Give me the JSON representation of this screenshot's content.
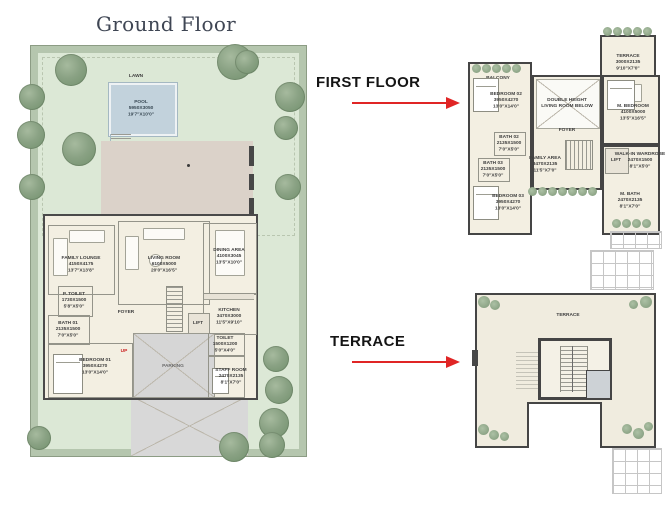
{
  "ground_floor": {
    "title": "Ground Floor",
    "labels": {
      "lawn": "LAWN",
      "pool": "POOL\n5950X3050\n19'7\"X10'0\"",
      "family_lounge": "FAMILY LOUNGE\n4150X4175\n13'7\"X13'8\"",
      "living_room": "LIVING ROOM\n6100X5000\n20'0\"X16'5\"",
      "dining_area": "DINING AREA\n4100X3045\n13'5\"X10'0\"",
      "p_toilet": "P. TOILET\n1730X1500\n5'8\"X5'0\"",
      "foyer": "FOYER",
      "stair_up": "UP",
      "kitchen": "KITCHEN\n3470X3000\n11'5\"X9'10\"",
      "lift": "LIFT",
      "bath_01": "BATH 01\n2135X1500\n7'0\"X5'0\"",
      "bedroom_01": "BEDROOM 01\n3950X4270\n13'0\"X14'0\"",
      "toilet": "TOILET\n1500X1200\n5'0\"X4'0\"",
      "staff_room": "STAFF ROOM\n2470X2135\n8'1\"X7'0\"",
      "parking": "PARKING"
    }
  },
  "first_floor": {
    "section_label": "FIRST FLOOR",
    "labels": {
      "terrace": "TERRACE\n3000X2135\n9'10\"X7'0\"",
      "balcony": "BALCONY",
      "bedroom_02": "BEDROOM 02\n3950X4270\n13'0\"X14'0\"",
      "double_height": "DOUBLE HEIGHT\nLIVING ROOM BELOW",
      "m_bedroom": "M. BEDROOM\n4100X5000\n13'5\"X16'5\"",
      "foyer": "FOYER",
      "family_area": "FAMILY AREA\n3470X2135\n11'5\"X7'0\"",
      "bath_02": "BATH 02\n2135X1500\n7'0\"X5'0\"",
      "bath_03": "BATH 03\n2135X1500\n7'0\"X5'0\"",
      "bedroom_03": "BEDROOM 03\n3950X4270\n13'0\"X14'0\"",
      "lift": "LIFT",
      "walk_in_wardrobe": "WALK-IN WARDROBE\n2470X1500\n8'1\"X5'0\"",
      "m_bath": "M. BATH\n2470X2135\n8'1\"X7'0\""
    }
  },
  "terrace_floor": {
    "section_label": "TERRACE",
    "labels": {
      "terrace": "TERRACE"
    }
  },
  "colors": {
    "arrow_red": "#e02525",
    "lawn_green": "#dce8d6",
    "hedge_green": "#b5c6ae",
    "pool_blue": "#c2d2dc",
    "deck_tan": "#dbd2c9",
    "floor_cream": "#f3efe2",
    "wall_dark": "#474747"
  }
}
